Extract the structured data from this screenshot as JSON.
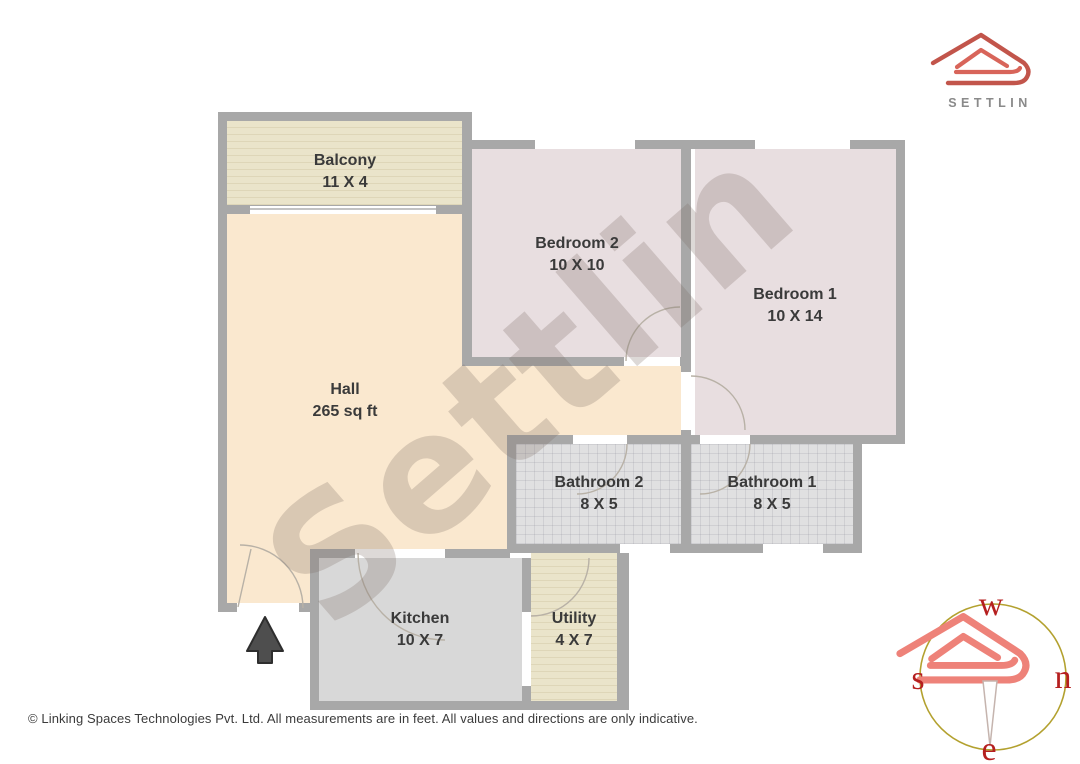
{
  "brand": {
    "name": "SETTLIN"
  },
  "watermark": {
    "text": "Settlin"
  },
  "rooms": {
    "balcony": {
      "label": "Balcony",
      "dimensions": "11 X 4"
    },
    "hall": {
      "label": "Hall",
      "dimensions": "265 sq ft"
    },
    "bedroom2": {
      "label": "Bedroom 2",
      "dimensions": "10 X 10"
    },
    "bedroom1": {
      "label": "Bedroom 1",
      "dimensions": "10 X 14"
    },
    "bathroom2": {
      "label": "Bathroom 2",
      "dimensions": "8 X 5"
    },
    "bathroom1": {
      "label": "Bathroom 1",
      "dimensions": "8 X 5"
    },
    "kitchen": {
      "label": "Kitchen",
      "dimensions": "10 X 7"
    },
    "utility": {
      "label": "Utility",
      "dimensions": "4 X 7"
    }
  },
  "compass": {
    "top": "w",
    "right": "n",
    "left": "s",
    "bottom": "e"
  },
  "footer": {
    "text": "© Linking Spaces Technologies Pvt. Ltd. All measurements are in feet. All values and directions are only indicative."
  },
  "colors": {
    "wall": "#a8a8a8",
    "hall_floor": "#fae8cf",
    "bedroom_floor": "#e8dee0",
    "bathroom_floor": "#e0e0e1",
    "kitchen_floor": "#d8d8d8",
    "deck_floor": "#eae4ca",
    "brand_red": "#c8544a",
    "brand_salmon": "#e0756c",
    "compass_letter": "#b51f1f",
    "compass_circle": "#b3a12f"
  }
}
